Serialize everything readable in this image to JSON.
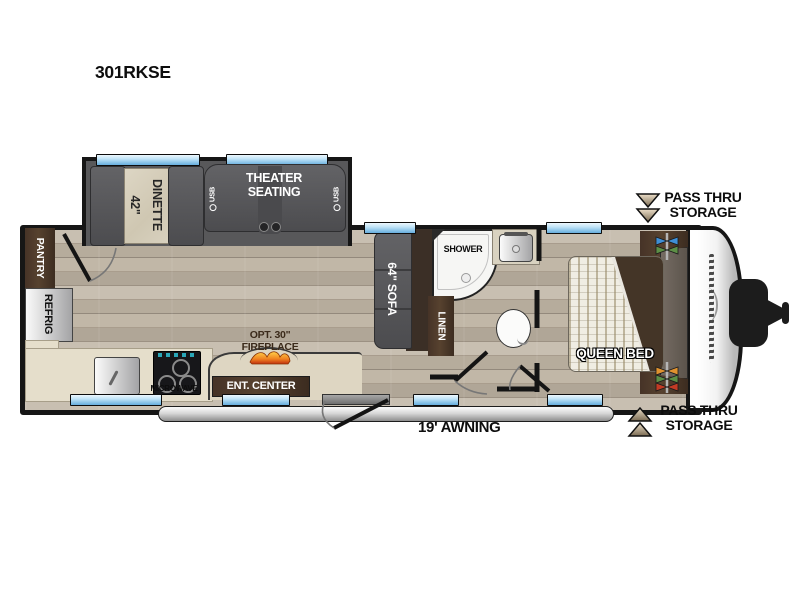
{
  "title": "301RKSE",
  "slideout": {
    "dinette_size": "42\"",
    "dinette_name": "DINETTE",
    "theater_label": "THEATER SEATING",
    "usb_left": "USB",
    "usb_right": "USB"
  },
  "kitchen": {
    "pantry_label": "PANTRY",
    "refrig_label": "REFRIG",
    "microwave_label": "MICROWAVE",
    "ent_center_label": "ENT. CENTER",
    "fireplace_line1": "OPT. 30\"",
    "fireplace_line2": "FIREPLACE"
  },
  "living": {
    "sofa_label": "64\" SOFA"
  },
  "bathroom": {
    "shower_label": "SHOWER",
    "linen_label": "LINEN"
  },
  "bedroom": {
    "bed_label": "QUEEN BED"
  },
  "exterior": {
    "awning_label": "19' AWNING",
    "pass_thru_top_line1": "PASS THRU",
    "pass_thru_top_line2": "STORAGE",
    "pass_thru_bottom_line1": "PASS THRU",
    "pass_thru_bottom_line2": "STORAGE"
  },
  "colors": {
    "wall": "#161616",
    "floor_tan": "#b7ad9f",
    "furniture_gray": "#565658",
    "cabinet_brown": "#473527",
    "counter_beige": "#e5decb",
    "window_blue": "#8ec6ec",
    "flame_orange": "#f08020",
    "hookup_blue": "#3f8fd6",
    "hookup_green": "#5d8f46",
    "hookup_orange": "#e0922f",
    "hookup_red": "#c23b25"
  }
}
